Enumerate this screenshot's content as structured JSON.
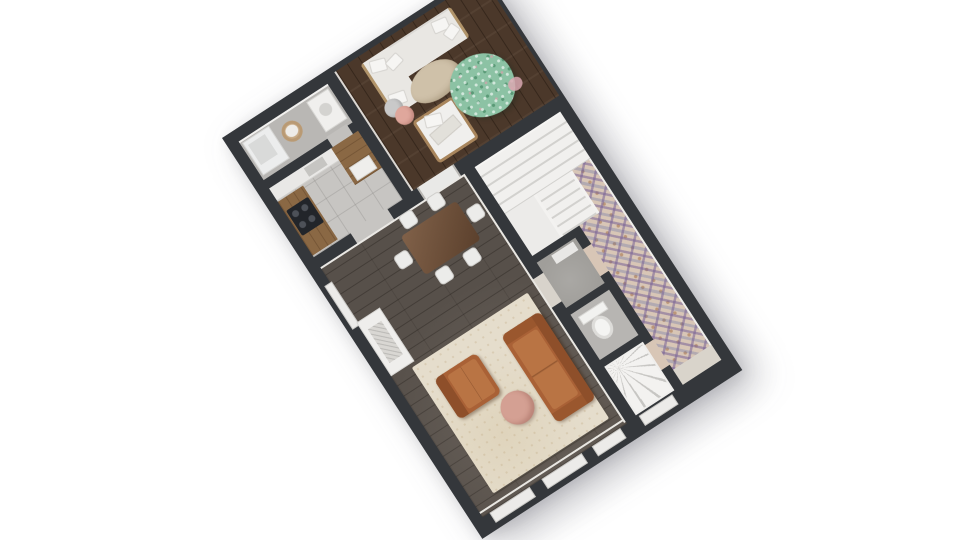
{
  "scene": {
    "type": "3d-floor-plan-render",
    "view": "top-down dollhouse view, plan rotated about -33 degrees on white background",
    "background_color": "#ffffff"
  },
  "palette": {
    "wall": "#34373b",
    "deck_wood": "#4b382a",
    "living_floor": "#57504a",
    "kitchen_floor": "#c7c5c2",
    "bath_floor": "#b9b7b4",
    "tile_base": "#d8c6b6",
    "tile_purple": "#7862a0",
    "tile_blue": "#5c6aa6",
    "tile_rust": "#a5704a",
    "stair_white": "#f1f0ee",
    "rug_cream": "#e5ddcc",
    "leather_cognac": "#a96136",
    "blush_pink": "#d4a093",
    "plant_green": "#8cc2a4",
    "counter_wood": "#8a6844",
    "dining_table_wood": "#6f4e36",
    "white_furniture": "#e9e7e3"
  },
  "rooms": [
    {
      "name": "laundry-bathroom",
      "floor": "gray",
      "contents": [
        "white-tub-counter",
        "round-woven-basket",
        "washing-machine"
      ]
    },
    {
      "name": "kitchen",
      "floor": "light-gray-tile",
      "contents": [
        "white-counter-with-sink",
        "wood-counter-left",
        "black-cooktop-4-burners",
        "wood-cabinet-with-white-appliance"
      ]
    },
    {
      "name": "terrace-deck",
      "floor": "dark-walnut-planks",
      "contents": [
        "white-l-sofa-with-pillows",
        "organic-oval-coffee-table",
        "gray-side-table",
        "pink-side-table",
        "wood-frame-armchair",
        "large-green-tree-with-pink-blossom"
      ]
    },
    {
      "name": "living-dining-room",
      "floor": "dark-gray-wood-planks",
      "contents": [
        "dining-table-6-white-chairs",
        "white-fireplace-console",
        "cream-area-rug",
        "cognac-leather-sofa",
        "cognac-leather-armchair",
        "round-blush-coffee-table",
        "three-windows-bottom-wall",
        "window-left-wall"
      ]
    },
    {
      "name": "stair-hall",
      "floor": "white",
      "contents": [
        "straight-staircase-upper-flight",
        "lower-flight",
        "landing"
      ]
    },
    {
      "name": "storage-room",
      "floor": "gray-concrete",
      "contents": [
        "white-shelf"
      ]
    },
    {
      "name": "toilet-room",
      "floor": "gray",
      "contents": [
        "toilet"
      ]
    },
    {
      "name": "spiral-stair-room",
      "floor": "white",
      "contents": [
        "winder-spiral-staircase",
        "exterior-door"
      ]
    },
    {
      "name": "tiled-corridor",
      "floor": "moroccan-patterned-encaustic-tile",
      "contents": [
        "doormat-threshold"
      ]
    }
  ],
  "openings": [
    "bathroom-to-kitchen-door",
    "kitchen-to-living-opening",
    "deck-glass-door-to-living",
    "living-to-hallway-door",
    "corridor-to-storage-door",
    "corridor-to-spiral-room-door"
  ]
}
